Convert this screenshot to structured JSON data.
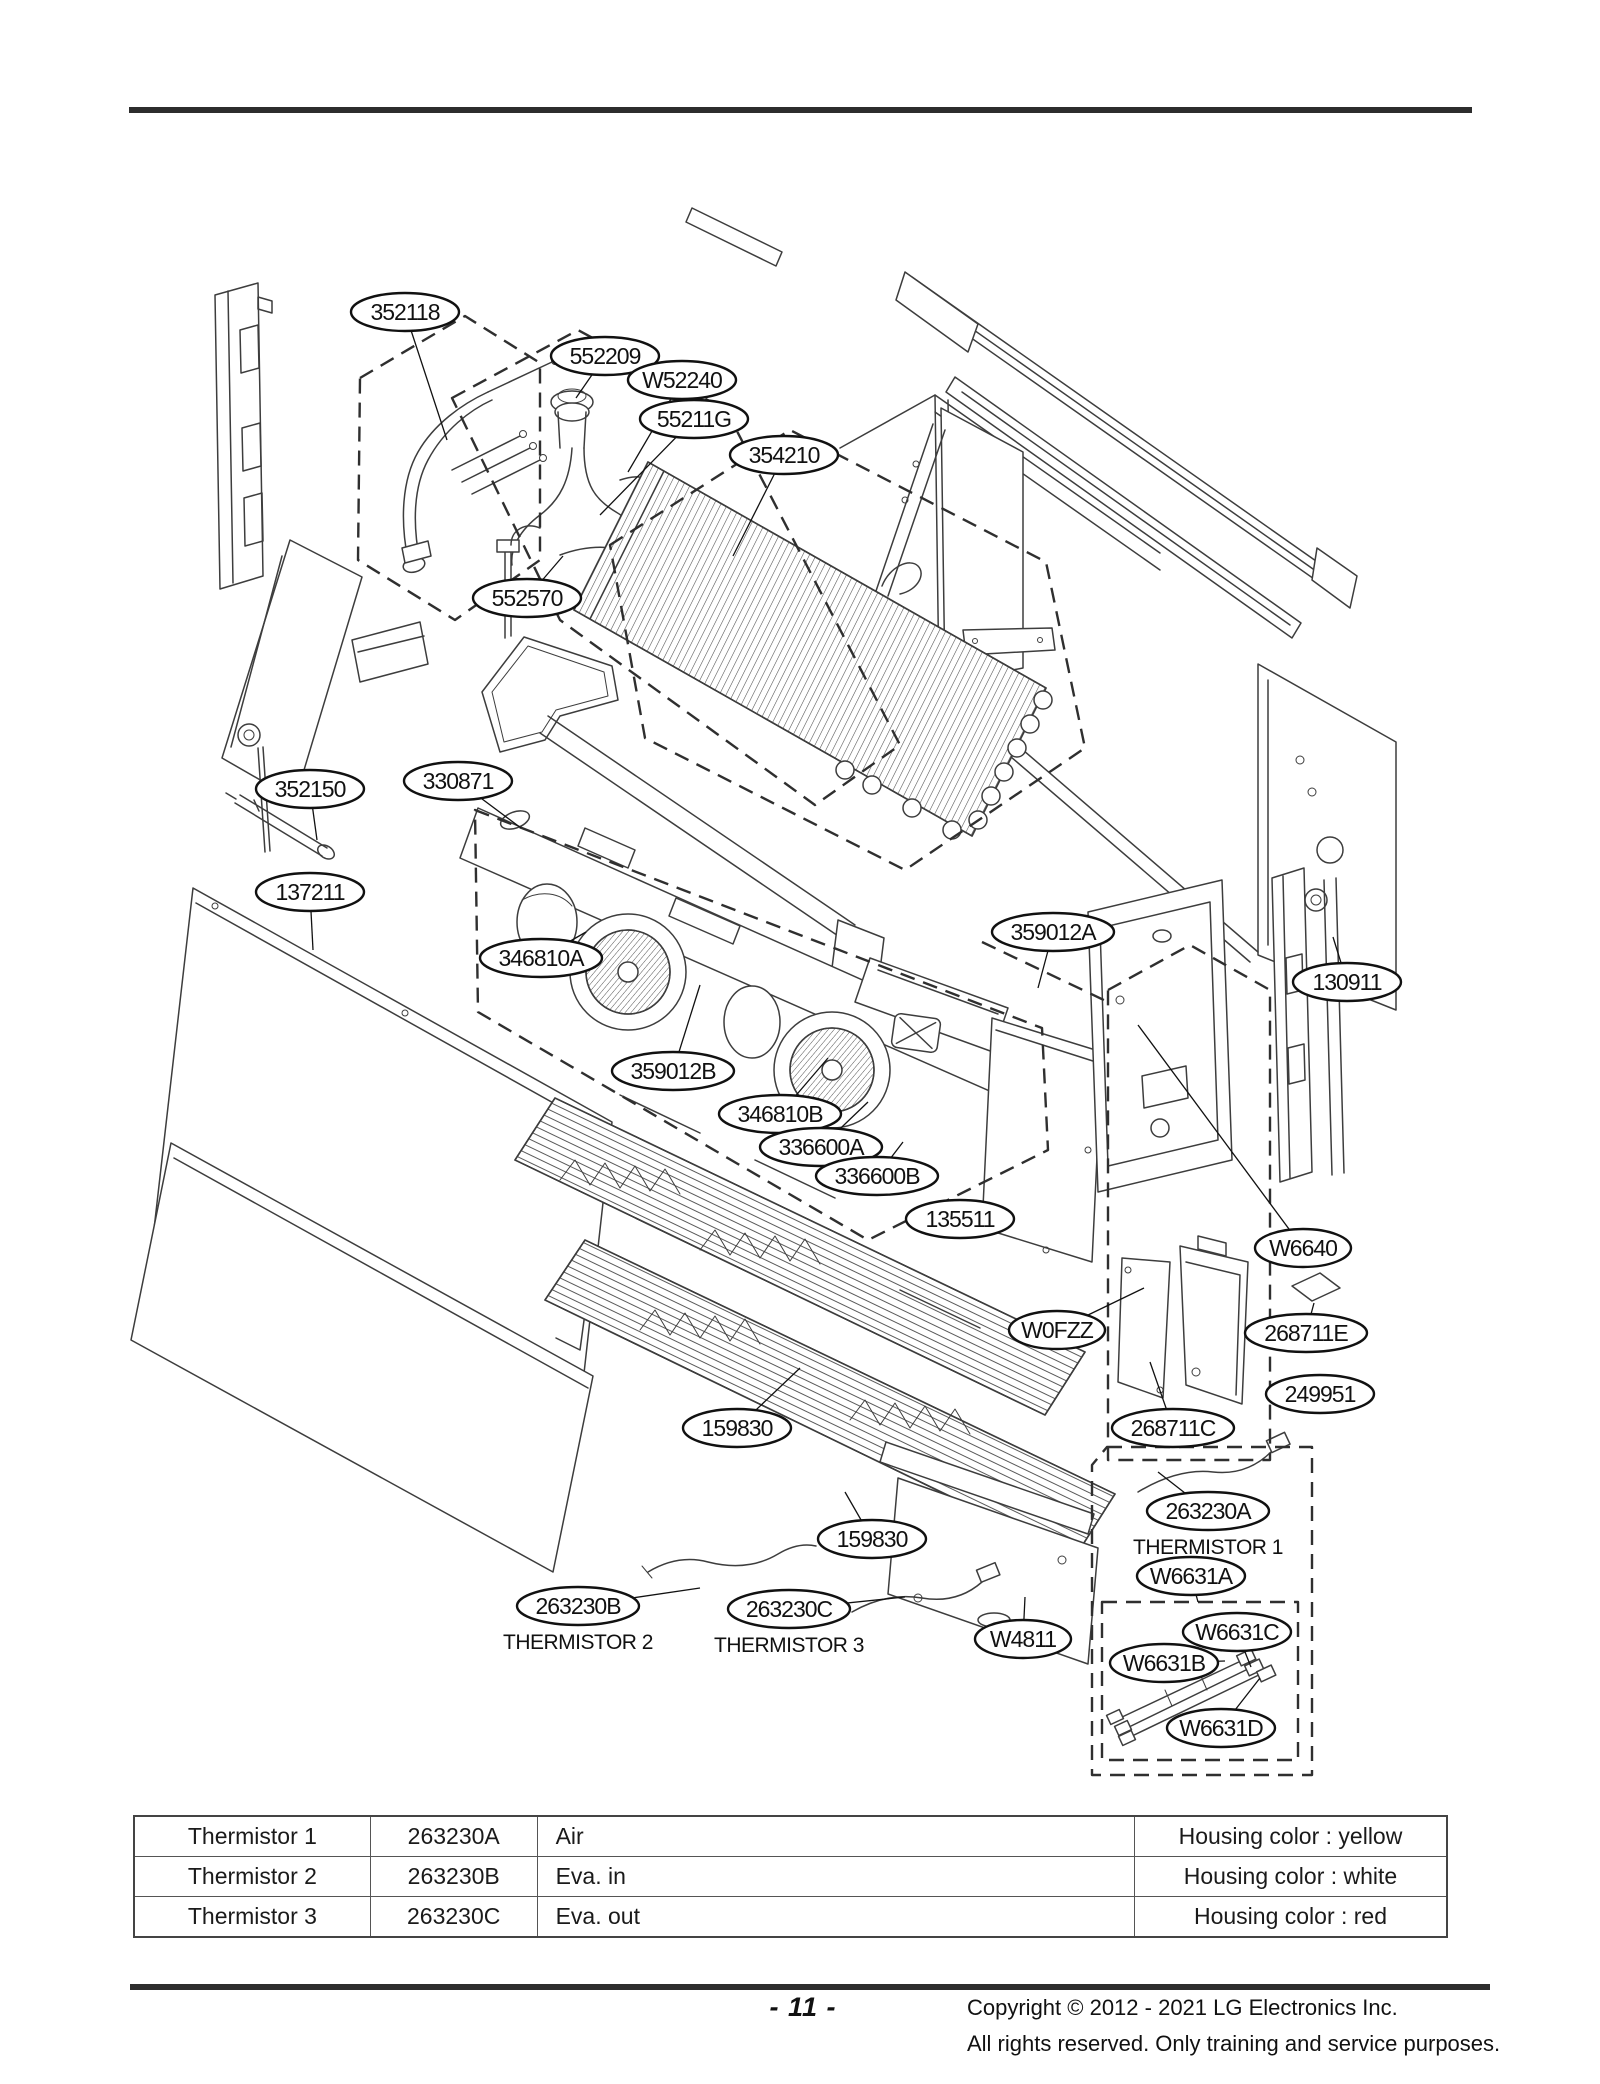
{
  "diagram": {
    "callouts": [
      {
        "label": "352118",
        "x": 405,
        "y": 312,
        "tx": 447,
        "ty": 440
      },
      {
        "label": "552209",
        "x": 605,
        "y": 356,
        "tx": 576,
        "ty": 398
      },
      {
        "label": "W52240",
        "x": 682,
        "y": 380,
        "tx": 628,
        "ty": 472
      },
      {
        "label": "55211G",
        "x": 694,
        "y": 419,
        "tx": 600,
        "ty": 515
      },
      {
        "label": "354210",
        "x": 784,
        "y": 455,
        "tx": 733,
        "ty": 556
      },
      {
        "label": "552570",
        "x": 527,
        "y": 598,
        "tx": 563,
        "ty": 556
      },
      {
        "label": "352150",
        "x": 310,
        "y": 789,
        "tx": 317,
        "ty": 840
      },
      {
        "label": "330871",
        "x": 458,
        "y": 781,
        "tx": 521,
        "ty": 828
      },
      {
        "label": "137211",
        "x": 310,
        "y": 892,
        "tx": 313,
        "ty": 950
      },
      {
        "label": "346810A",
        "x": 541,
        "y": 958,
        "tx": 586,
        "ty": 932
      },
      {
        "label": "359012A",
        "x": 1053,
        "y": 932,
        "tx": 1038,
        "ty": 988
      },
      {
        "label": "130911",
        "x": 1347,
        "y": 982,
        "tx": 1333,
        "ty": 937
      },
      {
        "label": "359012B",
        "x": 673,
        "y": 1071,
        "tx": 700,
        "ty": 985
      },
      {
        "label": "346810B",
        "x": 780,
        "y": 1114,
        "tx": 828,
        "ty": 1058
      },
      {
        "label": "336600A",
        "x": 821,
        "y": 1147,
        "tx": 868,
        "ty": 1102
      },
      {
        "label": "336600B",
        "x": 877,
        "y": 1176,
        "tx": 903,
        "ty": 1142
      },
      {
        "label": "135511",
        "x": 960,
        "y": 1219,
        "tx": 1008,
        "ty": 1218
      },
      {
        "label": "W6640",
        "x": 1303,
        "y": 1248,
        "tx": 1138,
        "ty": 1025
      },
      {
        "label": "W0FZZ",
        "x": 1057,
        "y": 1330,
        "tx": 1144,
        "ty": 1288
      },
      {
        "label": "268711E",
        "x": 1306,
        "y": 1333,
        "tx": 1314,
        "ty": 1303
      },
      {
        "label": "249951",
        "x": 1320,
        "y": 1394,
        "tx": 1273,
        "ty": 1392
      },
      {
        "label": "268711C",
        "x": 1173,
        "y": 1428,
        "tx": 1150,
        "ty": 1362
      },
      {
        "label": "159830",
        "x": 737,
        "y": 1428,
        "tx": 800,
        "ty": 1368
      },
      {
        "label": "159830",
        "x": 872,
        "y": 1539,
        "tx": 845,
        "ty": 1492
      },
      {
        "label": "263230A",
        "x": 1208,
        "y": 1511,
        "tx": 1158,
        "ty": 1472,
        "sub": "THERMISTOR 1"
      },
      {
        "label": "W6631A",
        "x": 1191,
        "y": 1576,
        "tx": 1198,
        "ty": 1602
      },
      {
        "label": "263230B",
        "x": 578,
        "y": 1606,
        "tx": 700,
        "ty": 1588,
        "sub": "THERMISTOR 2"
      },
      {
        "label": "263230C",
        "x": 789,
        "y": 1609,
        "tx": 905,
        "ty": 1597,
        "sub": "THERMISTOR 3"
      },
      {
        "label": "W4811",
        "x": 1023,
        "y": 1639,
        "tx": 1025,
        "ty": 1597
      },
      {
        "label": "W6631C",
        "x": 1237,
        "y": 1632,
        "tx": 1251,
        "ty": 1667
      },
      {
        "label": "W6631B",
        "x": 1164,
        "y": 1663,
        "tx": 1225,
        "ty": 1661
      },
      {
        "label": "W6631D",
        "x": 1221,
        "y": 1728,
        "tx": 1260,
        "ty": 1678
      }
    ]
  },
  "table": {
    "rows": [
      {
        "name": "Thermistor 1",
        "part_no": "263230A",
        "position": "Air",
        "housing": "Housing color : yellow"
      },
      {
        "name": "Thermistor 2",
        "part_no": "263230B",
        "position": "Eva. in",
        "housing": "Housing color : white"
      },
      {
        "name": "Thermistor 3",
        "part_no": "263230C",
        "position": "Eva. out",
        "housing": "Housing color : red"
      }
    ]
  },
  "footer": {
    "page_number": "- 11 -",
    "copyright_line1": "Copyright © 2012 - 2021 LG Electronics Inc.",
    "copyright_line2": "All rights reserved. Only training and service purposes."
  }
}
